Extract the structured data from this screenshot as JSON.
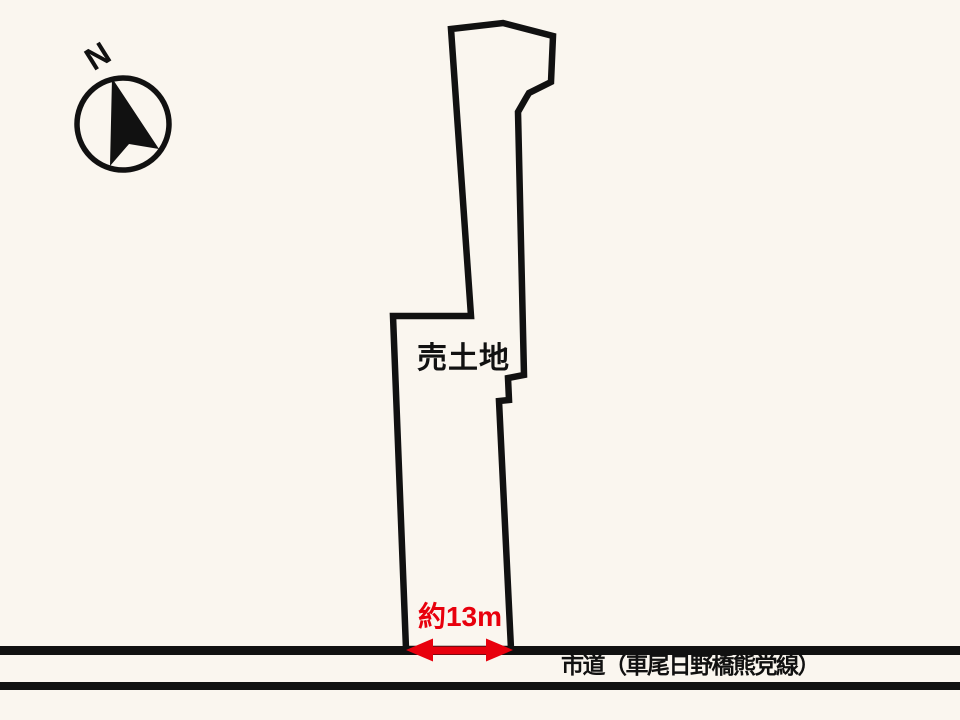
{
  "diagram": {
    "title_hint": "land-plot-diagram",
    "north_label": "N",
    "parcel_label": "売土地",
    "frontage_dimension": "約13m",
    "road_label": "市道（車尾日野橋熊党線）"
  },
  "colors": {
    "background": "#faf6ef",
    "line_black": "#111111",
    "dimension_red": "#e8000d"
  }
}
